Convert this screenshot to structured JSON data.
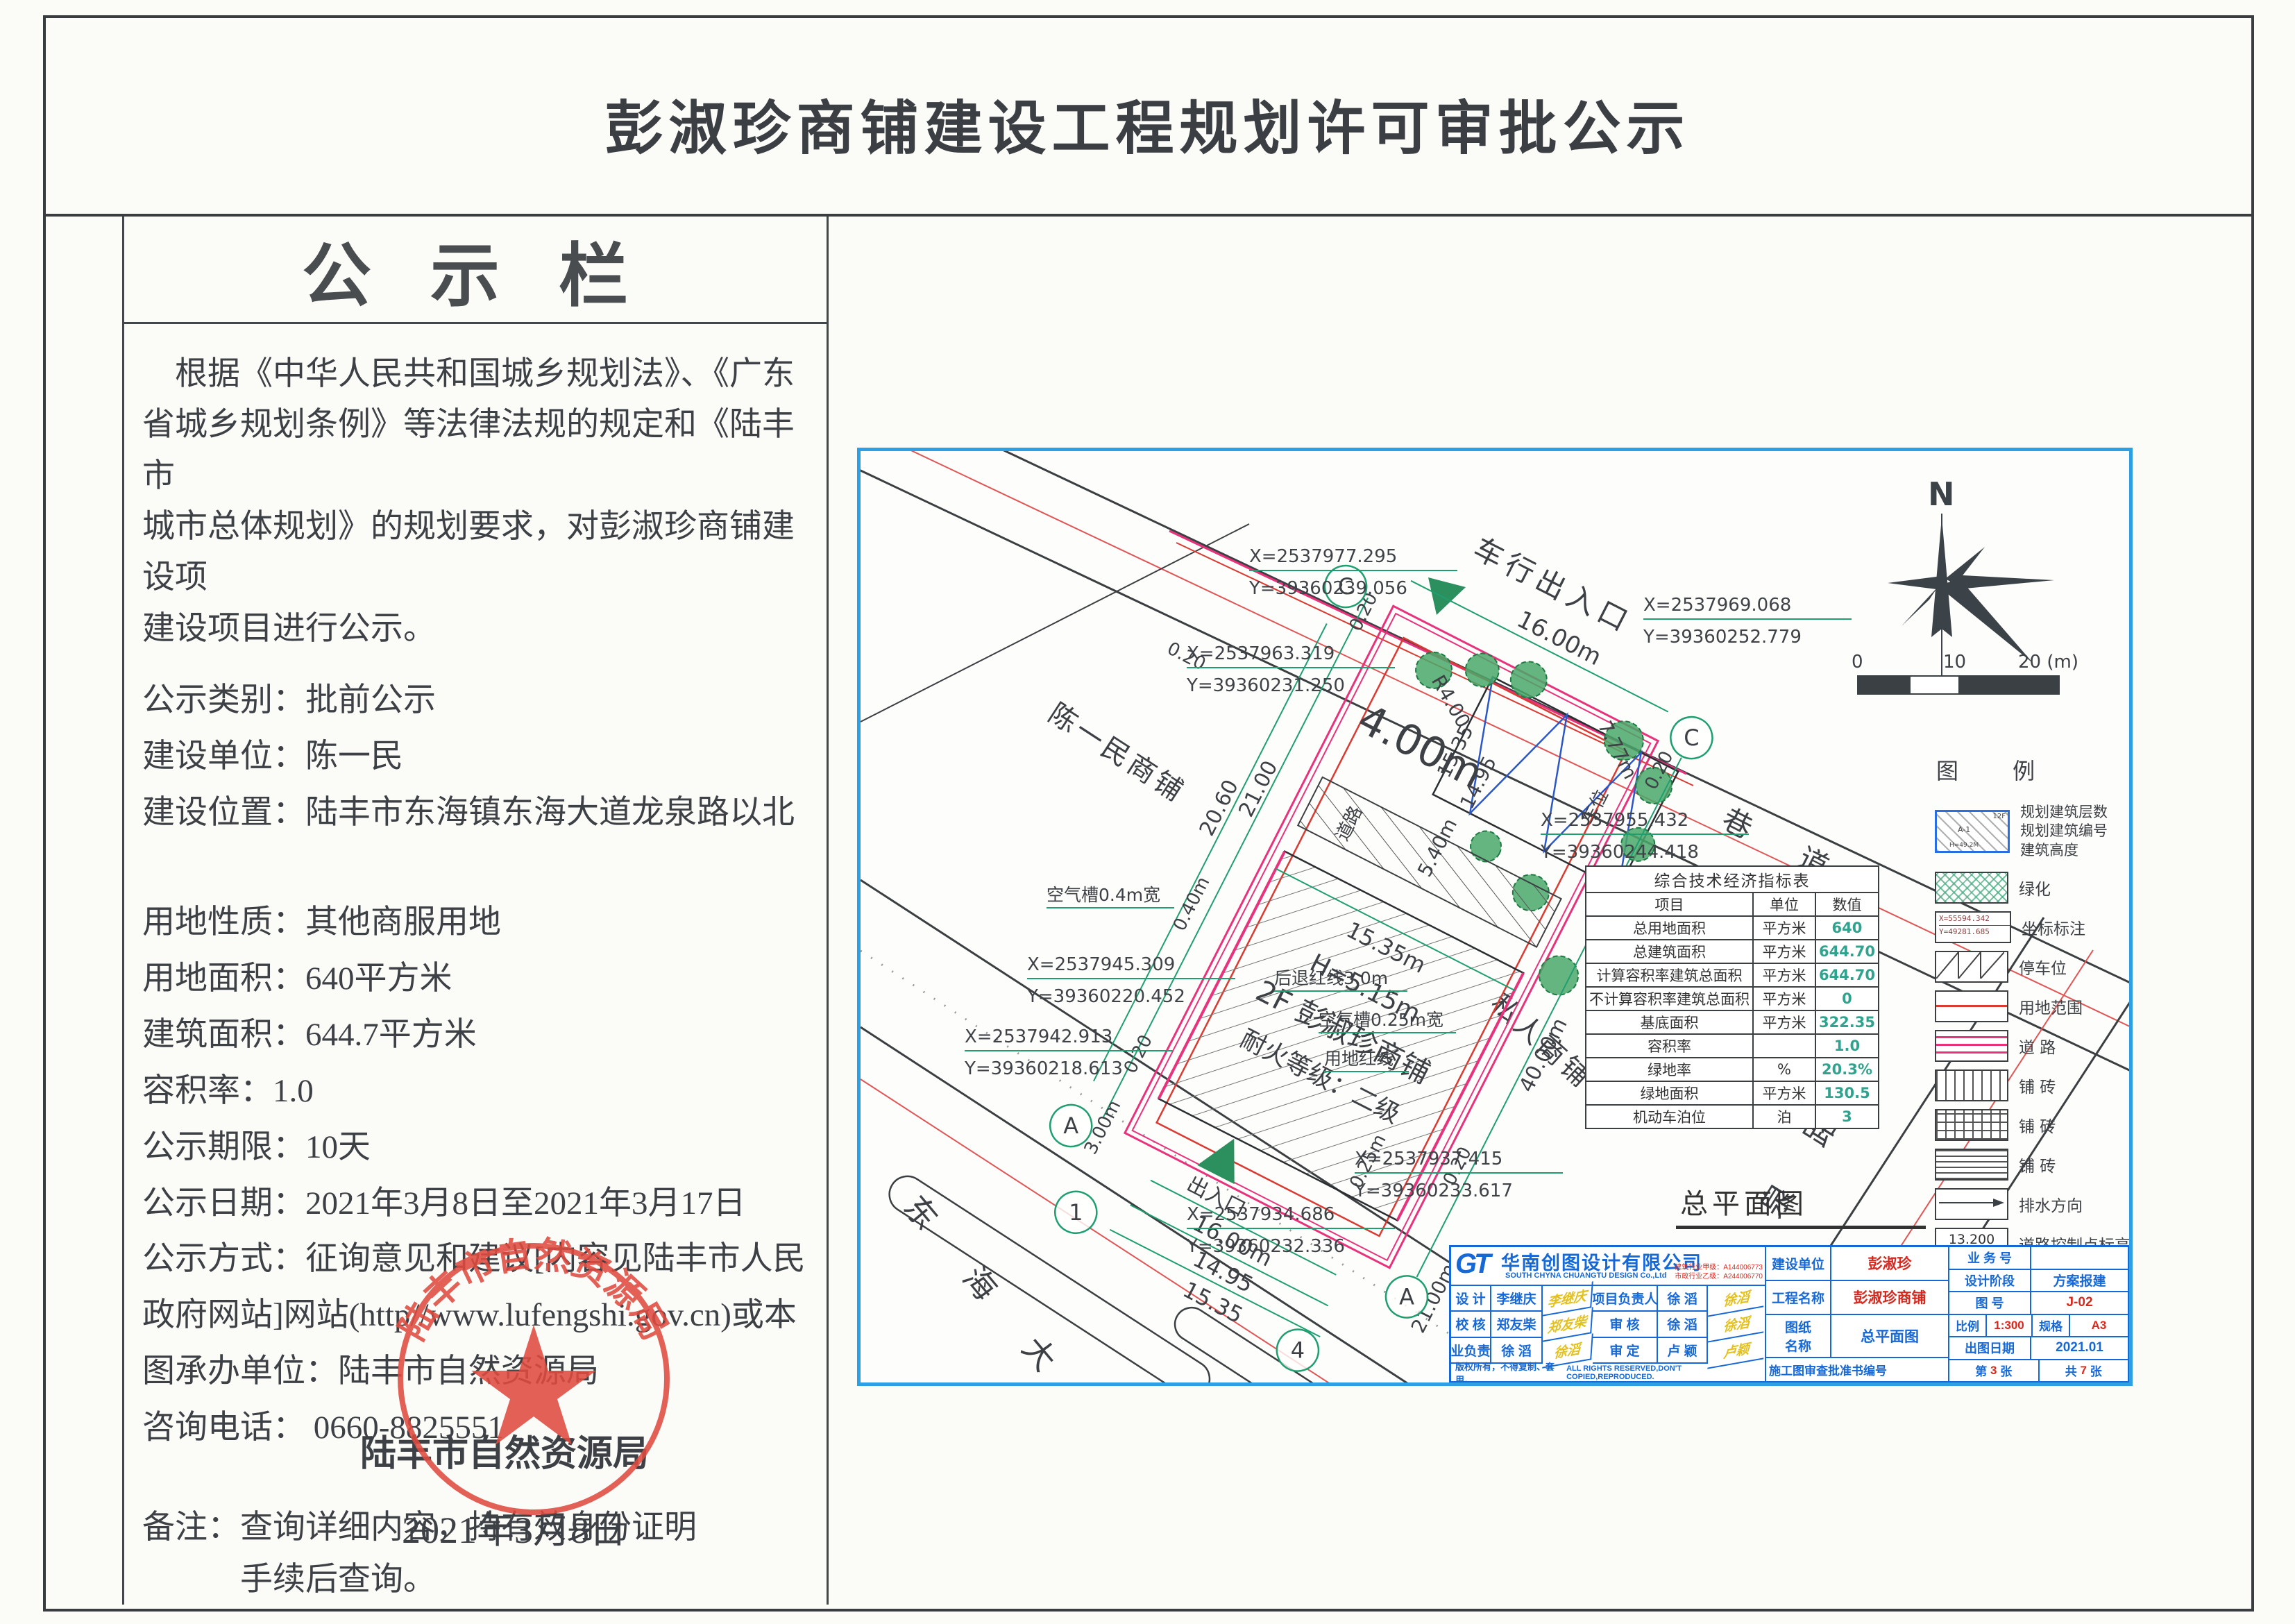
{
  "title": "彭淑珍商铺建设工程规划许可审批公示",
  "board": {
    "header": "公 示 栏",
    "intro": "    根据《中华人民共和国城乡规划法》、《广东\n省城乡规划条例》等法律法规的规定和《陆丰市\n城市总体规划》的规划要求，对彭淑珍商铺建设项\n建设项目进行公示。",
    "fields": [
      "公示类别：批前公示",
      "建设单位：陈一民",
      "建设位置：陆丰市东海镇东海大道龙泉路以北",
      "用地性质：其他商服用地",
      "用地面积：640平方米",
      "建筑面积：644.7平方米",
      "容积率：1.0",
      "公示期限：10天",
      "公示日期：2021年3月8日至2021年3月17日",
      "公示方式：征询意见和建议[内容见陆丰市人民政府网站]网站(http//www.lufengshi.gov.cn)或本图承办单位：陆丰市自然资源局",
      "咨询电话： 0660-8825551"
    ],
    "note": "备注：查询详细内容，持有效身份证明\n            手续后查询。",
    "agency": "陆丰市自然资源局",
    "date": "2021年3月8日",
    "stamp": "陆丰市自然资源局"
  },
  "plan": {
    "road_top": "车行出入口",
    "alley": "巷 道",
    "avenue": "东 海 大 道",
    "longquan": "龙 泉 路",
    "neighbor_left": "陈一民商铺",
    "neighbor_right": "私人商铺",
    "b_dim": "15.35m",
    "b_h": "H=5.15m",
    "b_name": "2F 彭淑珍商铺",
    "b_fire": "耐火等级：二级",
    "parking": "车位",
    "inner_road": "道路",
    "entrance": "出入口",
    "air04": "空气槽0.4m宽",
    "air025": "空气槽0.25m宽",
    "boundary": "用地红线",
    "setback": "后退红线3.0m",
    "dims": {
      "d2100": "21.00",
      "d2060": "20.60",
      "d4000": "40.00m",
      "d1600": "16.00m",
      "d1535": "15.35",
      "d1495": "14.95",
      "d540": "5.40m",
      "d400": "4.00m",
      "r400": "R4.00",
      "d777": "7.77m",
      "d020": "0.20",
      "d040": "0.40m",
      "d025": "0.25m",
      "d300": "3.00m",
      "d2100m": "21.00m"
    },
    "coords": [
      {
        "x": "X=2537977.295",
        "y": "Y=39360239.056"
      },
      {
        "x": "X=2537963.319",
        "y": "Y=39360231.250"
      },
      {
        "x": "X=2537969.068",
        "y": "Y=39360252.779"
      },
      {
        "x": "X=2537955.432",
        "y": "Y=39360244.418"
      },
      {
        "x": "X=2537945.309",
        "y": "Y=39360220.452"
      },
      {
        "x": "X=2537942.913",
        "y": "Y=39360218.613"
      },
      {
        "x": "X=2537937.415",
        "y": "Y=39360233.617"
      },
      {
        "x": "X=2537934.686",
        "y": "Y=39360232.336"
      }
    ],
    "axis_c": "C",
    "axis_a": "A",
    "axis_1": "1",
    "axis_4": "4",
    "north": "N",
    "scale0": "0",
    "scale10": "10",
    "scale20": "20 (m)",
    "cap": "总平面图",
    "cap_scale": "1:300"
  },
  "legend": {
    "title": "图 例",
    "sym_floors": "12F",
    "sym_code": "A-1",
    "sym_h": "H=49.2M",
    "l_floors": "规划建筑层数",
    "l_code": "规划建筑编号",
    "l_height": "建筑高度",
    "green": "绿化",
    "coord": "坐标标注",
    "coord_x": "X=55594.342",
    "coord_y": "Y=49281.685",
    "parking": "停车位",
    "land": "用地范围",
    "road": "道  路",
    "brick": "铺  砖",
    "drain": "排水方向",
    "elev": "道路控制点标高",
    "elev_v": "13.200"
  },
  "table": {
    "title": "综合技术经济指标表",
    "headers": [
      "项目",
      "单位",
      "数值"
    ],
    "rows": [
      [
        "总用地面积",
        "平方米",
        "640"
      ],
      [
        "总建筑面积",
        "平方米",
        "644.70"
      ],
      [
        "计算容积率建筑总面积",
        "平方米",
        "644.70"
      ],
      [
        "不计算容积率建筑总面积",
        "平方米",
        "0"
      ],
      [
        "基底面积",
        "平方米",
        "322.35"
      ],
      [
        "容积率",
        "",
        "1.0"
      ],
      [
        "绿地率",
        "%",
        "20.3%"
      ],
      [
        "绿地面积",
        "平方米",
        "130.5"
      ],
      [
        "机动车泊位",
        "泊",
        "3"
      ]
    ]
  },
  "tblock": {
    "logo": "GT",
    "company": "华南创图设计有限公司",
    "company_en": "SOUTH CHYNA CHUANGTU DESIGN Co.,Ltd",
    "cred1": "建筑行业甲级：A144006773",
    "cred2": "市政行业乙级：A244006770",
    "r1l": "设  计",
    "r1v": "李继庆",
    "r1s": "李继庆",
    "r2l": "项目负责人",
    "r2v": "徐  滔",
    "r2s": "徐滔",
    "r3l": "校  核",
    "r3v": "郑友柴",
    "r3s": "郑友柴",
    "r4l": "审  核",
    "r4v": "徐  滔",
    "r4s": "徐滔",
    "r5l": "专业负责人",
    "r5v": "徐  滔",
    "r5s": "徐滔",
    "r6l": "审  定",
    "r6v": "卢  颖",
    "r6s": "卢颖",
    "copyright": "版权所有，不得复制、套用。",
    "rights": "ALL RIGHTS RESERVED,DON'T COPIED,REPRODUCED.",
    "owner_l": "建设单位",
    "owner": "彭淑珍",
    "proj_l": "工程名称",
    "proj": "彭淑珍商铺",
    "sheet_l": "图纸\n名称",
    "sheet": "总平面图",
    "approval_l": "施工图审查批准书编号",
    "biz_l": "业 务 号",
    "stage_l": "设计阶段",
    "stage": "方案报建",
    "fig_l": "图  号",
    "fig": "J-02",
    "scale_l": "比例",
    "scale": "1:300",
    "size_l": "规格",
    "size": "A3",
    "date_l": "出图日期",
    "date": "2021.01",
    "p1": "第",
    "p2": "3",
    "p3": "张",
    "t1": "共",
    "t2": "7",
    "t3": "张"
  }
}
